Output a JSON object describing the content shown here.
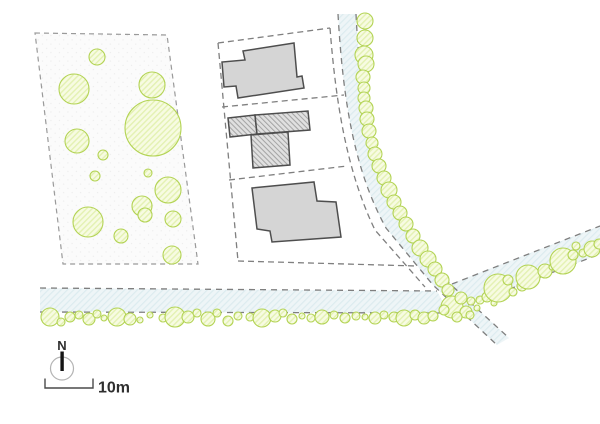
{
  "meta": {
    "type": "architectural-site-plan"
  },
  "compass": {
    "label": "N"
  },
  "scale": {
    "label": "10m"
  },
  "colors": {
    "background": "#ffffff",
    "parcel_fill": "#fbfbfb",
    "parcel_dot": "#e7e7e7",
    "parcel_dash": "#9a9a9a",
    "line_dash": "#7f7f7f",
    "road_fill": "#eef5f7",
    "road_hatch": "#dcebef",
    "tree_stroke": "#b3d354",
    "tree_fill": "#f7fbe2",
    "tree_hatch": "#e3f1b2",
    "building_fill": "#d5d5d5",
    "building_stroke": "#4e4e4e",
    "bldg_hatch_bg": "#e0e0e0",
    "bldg_hatch_line": "#a3a3a3",
    "compass_ring": "#b3b3b3",
    "needle": "#141414",
    "ink": "#2f2f2f",
    "scale_line": "#4a4a4a"
  },
  "plan": {
    "parcels": [
      {
        "name": "wooded-parcel",
        "points": "35,33 167,35 198,264 63,264",
        "dash": "5 4"
      }
    ],
    "roads": [
      {
        "name": "north-road-surface",
        "path": "M338,14 L356,14 C360,95 371,165 402,221 L449,283 L509,338 L497,345 L433,285 L386,228 C354,170 343,100 338,14 Z"
      },
      {
        "name": "main-road-surface",
        "path": "M40,288 L437,291 L449,313 L40,312 Z"
      },
      {
        "name": "east-road-surface",
        "path": "M448,285 L600,226 L600,254 L456,310 Z"
      }
    ],
    "lines": [
      {
        "name": "block-top-boundary",
        "path": "M218,43 L330,28",
        "dash": "6 4"
      },
      {
        "name": "block-left-boundary",
        "path": "M218,43 L238,261",
        "dash": "6 4"
      },
      {
        "name": "block-right-boundary",
        "path": "M330,28 C336,105 347,172 375,230 L425,287",
        "dash": "6 4"
      },
      {
        "name": "block-bottom-boundary",
        "path": "M238,261 L417,266",
        "dash": "6 4"
      },
      {
        "name": "lot-divider-north",
        "path": "M222,107 L344,95",
        "dash": "6 4"
      },
      {
        "name": "lot-divider-south",
        "path": "M229,180 L347,166",
        "dash": "6 4"
      },
      {
        "name": "north-road-west-edge",
        "path": "M338,14 C343,100 354,170 386,228 L433,285 L497,345",
        "dash": "6 5"
      },
      {
        "name": "north-road-east-edge",
        "path": "M356,14 C360,95 371,165 402,221 L449,283 L509,338",
        "dash": "6 5"
      },
      {
        "name": "main-road-north-edge",
        "path": "M40,288 L437,291",
        "dash": "6 5"
      },
      {
        "name": "main-road-south-edge",
        "path": "M40,312 L444,313",
        "dash": "6 5"
      },
      {
        "name": "east-road-north-edge",
        "path": "M452,284 L600,226",
        "dash": "6 5"
      },
      {
        "name": "east-road-south-edge",
        "path": "M458,309 L600,254",
        "dash": "6 5"
      }
    ],
    "buildings": [
      {
        "name": "building-north",
        "hatched": false,
        "points": "243,51 294,43 297,77 302,76 304,88 238,98 236,86 224,87 222,62 245,60"
      },
      {
        "name": "building-middle-bar-west",
        "hatched": true,
        "points": "228,118 255,115 257,134 230,137"
      },
      {
        "name": "building-middle-bar-east",
        "hatched": true,
        "points": "255,115 308,111 310,130 257,134"
      },
      {
        "name": "building-middle-stem",
        "hatched": true,
        "points": "251,135 288,132 290,165 253,168"
      },
      {
        "name": "building-south",
        "hatched": false,
        "points": "252,188 314,182 317,201 336,202 341,237 272,242 270,231 257,229"
      }
    ],
    "trees": {
      "parcel": [
        [
          97,
          57,
          8
        ],
        [
          74,
          89,
          15
        ],
        [
          152,
          85,
          13
        ],
        [
          153,
          128,
          28
        ],
        [
          77,
          141,
          12
        ],
        [
          103,
          155,
          5
        ],
        [
          95,
          176,
          5
        ],
        [
          148,
          173,
          4
        ],
        [
          168,
          190,
          13
        ],
        [
          142,
          206,
          10
        ],
        [
          145,
          215,
          7
        ],
        [
          88,
          222,
          15
        ],
        [
          121,
          236,
          7
        ],
        [
          173,
          219,
          8
        ],
        [
          172,
          255,
          9
        ]
      ],
      "north_road": [
        [
          365,
          21,
          8
        ],
        [
          365,
          38,
          8
        ],
        [
          364,
          55,
          9
        ],
        [
          366,
          64,
          8
        ],
        [
          363,
          77,
          7
        ],
        [
          364,
          88,
          6
        ],
        [
          364,
          98,
          6
        ],
        [
          366,
          108,
          7
        ],
        [
          367,
          119,
          7
        ],
        [
          369,
          131,
          7
        ],
        [
          372,
          143,
          6
        ],
        [
          375,
          154,
          7
        ],
        [
          379,
          166,
          7
        ],
        [
          384,
          178,
          7
        ],
        [
          389,
          190,
          8
        ],
        [
          394,
          202,
          7
        ],
        [
          400,
          213,
          7
        ],
        [
          406,
          224,
          7
        ],
        [
          413,
          236,
          7
        ],
        [
          420,
          248,
          8
        ],
        [
          428,
          259,
          8
        ],
        [
          435,
          269,
          7
        ],
        [
          442,
          280,
          7
        ],
        [
          448,
          290,
          6
        ]
      ],
      "intersection": [
        [
          452,
          307,
          11
        ],
        [
          461,
          298,
          6
        ],
        [
          466,
          312,
          6
        ],
        [
          457,
          317,
          5
        ],
        [
          471,
          301,
          4
        ],
        [
          470,
          315,
          4
        ],
        [
          477,
          308,
          3
        ],
        [
          444,
          310,
          5
        ]
      ],
      "east_road": [
        [
          480,
          300,
          4
        ],
        [
          487,
          297,
          5
        ],
        [
          494,
          303,
          3
        ],
        [
          498,
          288,
          14
        ],
        [
          508,
          280,
          5
        ],
        [
          513,
          292,
          4
        ],
        [
          522,
          286,
          5
        ],
        [
          528,
          277,
          12
        ],
        [
          545,
          271,
          7
        ],
        [
          552,
          267,
          3
        ],
        [
          563,
          261,
          13
        ],
        [
          573,
          255,
          5
        ],
        [
          583,
          253,
          4
        ],
        [
          592,
          249,
          8
        ],
        [
          576,
          246,
          4
        ],
        [
          599,
          244,
          5
        ]
      ],
      "main_road": [
        [
          50,
          317,
          9
        ],
        [
          61,
          322,
          4
        ],
        [
          70,
          317,
          5
        ],
        [
          79,
          315,
          4
        ],
        [
          89,
          319,
          6
        ],
        [
          97,
          314,
          4
        ],
        [
          104,
          318,
          3
        ],
        [
          117,
          317,
          9
        ],
        [
          130,
          319,
          6
        ],
        [
          140,
          320,
          3
        ],
        [
          150,
          315,
          3
        ],
        [
          163,
          318,
          4
        ],
        [
          175,
          317,
          10
        ],
        [
          188,
          317,
          6
        ],
        [
          197,
          313,
          4
        ],
        [
          208,
          319,
          7
        ],
        [
          217,
          313,
          4
        ],
        [
          228,
          321,
          5
        ],
        [
          238,
          316,
          4
        ],
        [
          250,
          317,
          4
        ],
        [
          262,
          318,
          9
        ],
        [
          275,
          316,
          6
        ],
        [
          283,
          313,
          4
        ],
        [
          292,
          319,
          5
        ],
        [
          302,
          316,
          3
        ],
        [
          311,
          318,
          4
        ],
        [
          322,
          317,
          7
        ],
        [
          334,
          315,
          4
        ],
        [
          345,
          318,
          5
        ],
        [
          356,
          316,
          4
        ],
        [
          365,
          317,
          3
        ],
        [
          375,
          318,
          6
        ],
        [
          384,
          315,
          4
        ],
        [
          394,
          317,
          5
        ],
        [
          404,
          318,
          8
        ],
        [
          415,
          315,
          5
        ],
        [
          424,
          318,
          6
        ],
        [
          433,
          316,
          5
        ]
      ]
    }
  }
}
